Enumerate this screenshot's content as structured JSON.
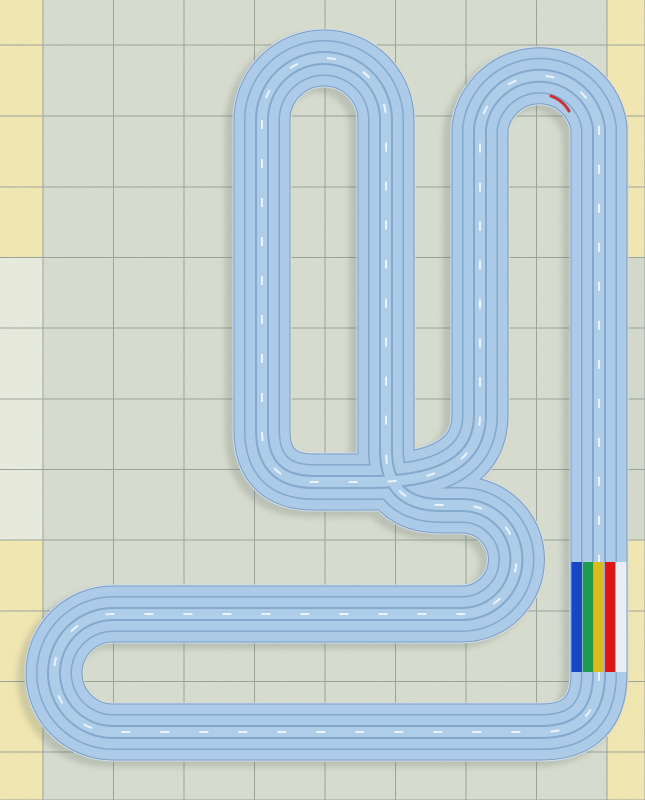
{
  "scene": {
    "kind": "slot-car-track-plan-view",
    "canvas": {
      "width": 645,
      "height": 800
    },
    "lane_count": 5
  },
  "floor": {
    "line_color": "#98a29b",
    "tile_edge_xs": [
      0,
      43,
      113.5,
      184,
      254.5,
      325,
      395.5,
      466,
      536.5,
      607,
      645
    ],
    "tile_edge_ys": [
      0,
      45,
      116,
      187,
      257.5,
      328,
      399,
      469.5,
      540,
      611,
      681.5,
      752,
      800
    ],
    "colors": {
      "field": "#dbe0d2",
      "yellow": "#f8ecb2",
      "pale_left_mid": "#edf0e1",
      "right_mid": "#d8ddcf"
    },
    "border_yellow_rows": [
      0,
      1,
      2,
      3,
      8,
      9,
      10,
      11
    ],
    "left_col_index": 0,
    "right_col_index": 9,
    "noise_opacity": 0.5
  },
  "track": {
    "path": "M 262,120 L 262,430 Q 262,482 314,482 L 370,482 Q 480,482 480,415 L 480,128 A 60 60 0 0 1 599,128 L 599,674 Q 599,732 541,732 L 113,732 A 59 59 0 0 1 113,614 L 462,614 A 54.5 54.5 0 0 0 462,505 L 441,505 Q 386,505 386,450 L 386,120 A 62 62 0 0 0 262,120 Z",
    "shadow": {
      "dx": -7,
      "dy": 5,
      "width": 60,
      "color": "#5a665c",
      "opacity": 0.22,
      "blur": 3
    },
    "layers": [
      {
        "w": 59,
        "c": "#cfdeed"
      },
      {
        "w": 57,
        "c": "#7e9cbf"
      },
      {
        "w": 55,
        "c": "#abcbe9"
      },
      {
        "w": 36,
        "c": "#84a9cd"
      },
      {
        "w": 33,
        "c": "#abcbe9"
      },
      {
        "w": 14,
        "c": "#84a9cd"
      },
      {
        "w": 10,
        "c": "#aecde9"
      }
    ],
    "center_dash": {
      "w": 2,
      "c": "rgba(255,255,255,0.75)",
      "dash": "9 30"
    },
    "red_marker": {
      "path": "M 569,111 A 34 34 0 0 0 551,96",
      "color": "#cf1f1f",
      "w": 3,
      "opacity": 0.9
    }
  },
  "start_line": {
    "x": 571.5,
    "y": 562,
    "height": 110,
    "lane_width": 11,
    "lane_colors": [
      "#1747c6",
      "#1f9a51",
      "#d8bc1c",
      "#e01414",
      "#e8eef4"
    ],
    "lane_names": [
      "blue-lane",
      "green-lane",
      "yellow-lane",
      "red-lane",
      "white-lane"
    ],
    "separator_color": "#8fb0cf"
  }
}
